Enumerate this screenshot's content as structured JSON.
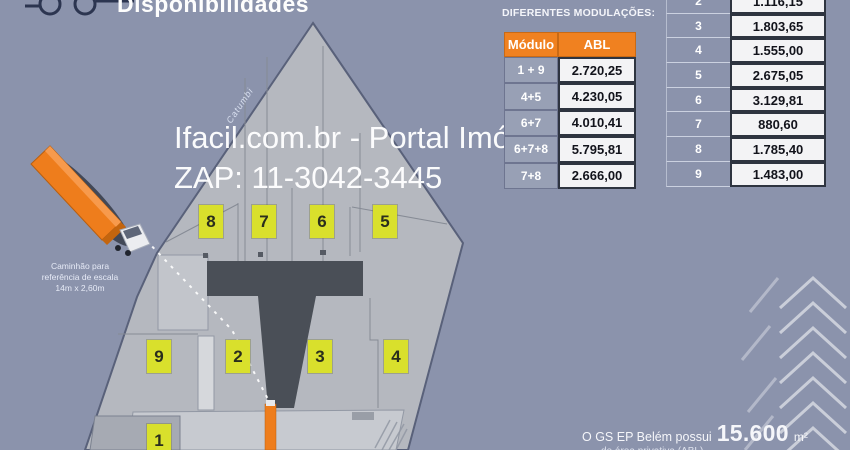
{
  "title": "Disponibilidades",
  "watermark": {
    "line1": "Ifacil.com.br - Portal Imóvel Fácil",
    "line2": "ZAP: 11-3042-3445"
  },
  "modulations_table": {
    "title": "DIFERENTES MODULAÇÕES:",
    "col_module": "Módulo",
    "col_abl": "ABL",
    "rows": [
      {
        "module": "1 + 9",
        "abl": "2.720,25"
      },
      {
        "module": "4+5",
        "abl": "4.230,05"
      },
      {
        "module": "6+7",
        "abl": "4.010,41"
      },
      {
        "module": "6+7+8",
        "abl": "5.795,81"
      },
      {
        "module": "7+8",
        "abl": "2.666,00"
      }
    ]
  },
  "modules_table": {
    "rows": [
      {
        "module": "2",
        "abl": "1.116,15"
      },
      {
        "module": "3",
        "abl": "1.803,65"
      },
      {
        "module": "4",
        "abl": "1.555,00"
      },
      {
        "module": "5",
        "abl": "2.675,05"
      },
      {
        "module": "6",
        "abl": "3.129,81"
      },
      {
        "module": "7",
        "abl": "880,60"
      },
      {
        "module": "8",
        "abl": "1.785,40"
      },
      {
        "module": "9",
        "abl": "1.483,00"
      }
    ]
  },
  "plan": {
    "street_label": "Catumbi",
    "badges": [
      "8",
      "7",
      "6",
      "5",
      "9",
      "2",
      "3",
      "4",
      "1"
    ]
  },
  "truck_reference": {
    "caption_line1": "Caminhão para",
    "caption_line2": "referência de escala",
    "caption_line3": "14m x 2,60m"
  },
  "footer": {
    "text": "O GS EP Belém possui",
    "area_value": "15.600",
    "area_unit": "m²",
    "clipped_line": "de área privativa (ABL)"
  },
  "colors": {
    "background": "#8B93AC",
    "accent_orange": "#F08120",
    "badge_yellow": "#D9E02C",
    "road_dark": "#4A4F57",
    "building_gray": "#B5B8BF"
  }
}
